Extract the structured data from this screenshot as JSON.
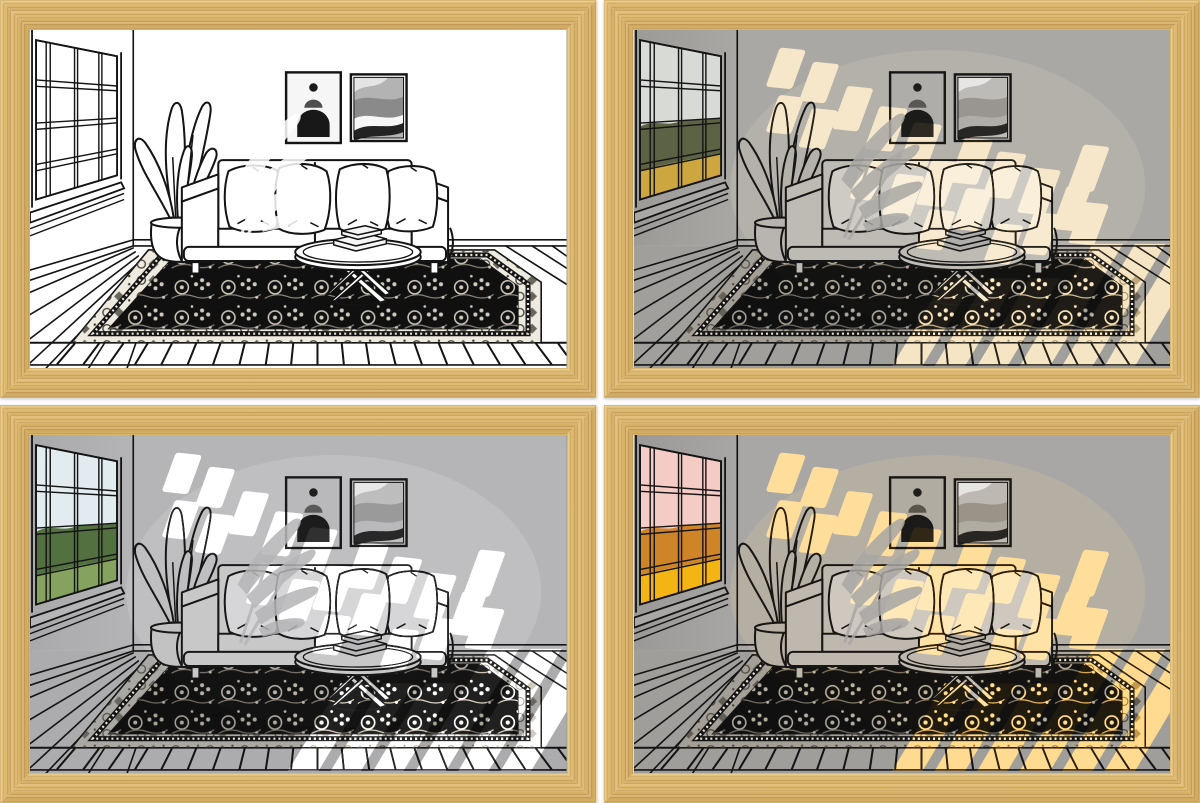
{
  "image_kind": "product-photo-grid-of-framed-light-art",
  "page": {
    "background": "#ffffff",
    "grid": "2x2",
    "gutter_px": 7
  },
  "frame": {
    "material": "light-oak-wood",
    "border_px": 30,
    "wood_base": "#d6b069",
    "wood_light": "#e6c67f",
    "wood_dark": "#cda45c"
  },
  "scene": {
    "description": "line-art living room interior",
    "elements": [
      "paned-window",
      "window-sill",
      "potted-plant",
      "sofa",
      "throw-pillows",
      "wall-poster-arch",
      "wall-poster-waves",
      "round-coffee-table",
      "books",
      "oriental-rug",
      "plank-floor",
      "baseboard",
      "sunlight-window-patches",
      "plant-shadow"
    ]
  },
  "panels": [
    {
      "id": "p1",
      "position": "top-left",
      "lighting": "off-white-background",
      "palette": {
        "wall": "#ffffff",
        "floor": "#ffffff",
        "sofa": "#ffffff",
        "pillow": "#ffffff",
        "paper": "#f6f6f6",
        "pot": "#ffffff",
        "rugBorder": "#eeeae0",
        "sky": "#ffffff",
        "foliage": "#ffffff",
        "field": "#ffffff",
        "light": "rgba(0,0,0,0)",
        "motifAlpha": "1",
        "shadeAlpha": "0"
      }
    },
    {
      "id": "p2",
      "position": "top-right",
      "lighting": "warm-glow-on-gray",
      "palette": {
        "wall": "#aaa8a5",
        "floor": "#a19f9c",
        "sofa": "#b5b3b0",
        "pillow": "#c7c4c0",
        "paper": "#a4a4a4",
        "pot": "#aeacaa",
        "rugBorder": "#a49f96",
        "sky": "#d8dad6",
        "foliage": "#5c6244",
        "field": "#cda640",
        "light": "#f3ddb5",
        "motifAlpha": "0.8",
        "shadeAlpha": "0.15"
      }
    },
    {
      "id": "p3",
      "position": "bottom-left",
      "lighting": "cool-white-on-gray",
      "palette": {
        "wall": "#b5b5b7",
        "floor": "#acacae",
        "sofa": "#bfbfc1",
        "pillow": "#d0d0d2",
        "paper": "#aeaeb0",
        "pot": "#b8b8ba",
        "rugBorder": "#aaa8a2",
        "sky": "#e2ebf0",
        "foliage": "#527040",
        "field": "#85a35e",
        "light": "#ffffff",
        "motifAlpha": "0.8",
        "shadeAlpha": "0.12"
      }
    },
    {
      "id": "p4",
      "position": "bottom-right",
      "lighting": "strong-warm-sunset",
      "palette": {
        "wall": "#a9a7a5",
        "floor": "#a09e9b",
        "sofa": "#b4b2af",
        "pillow": "#c6c3bf",
        "paper": "#a4a4a4",
        "pot": "#adaba8",
        "rugBorder": "#a49f96",
        "sky": "#f5cbc6",
        "foliage": "#d08428",
        "field": "#f4b414",
        "light": "#ffcf72",
        "motifAlpha": "0.85",
        "shadeAlpha": "0.15"
      }
    }
  ]
}
